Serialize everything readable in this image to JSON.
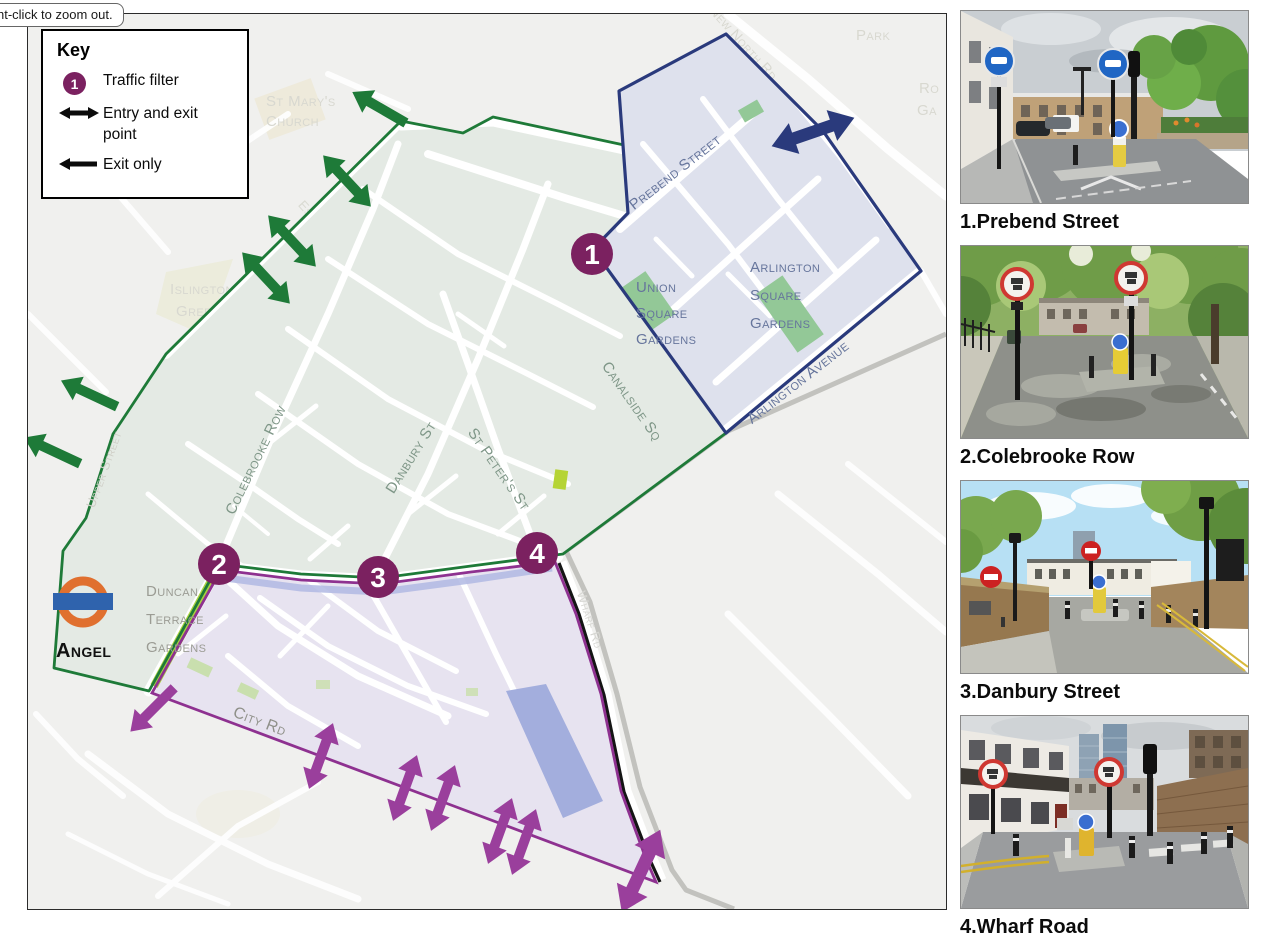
{
  "tooltip": {
    "text": "ht-click to zoom out."
  },
  "key": {
    "title": "Key",
    "items": [
      {
        "symbol": "traffic-filter-circle",
        "number": "1",
        "label": "Traffic filter"
      },
      {
        "symbol": "double-arrow",
        "label": "Entry and exit point"
      },
      {
        "symbol": "single-arrow",
        "label": "Exit only"
      }
    ]
  },
  "map": {
    "filters": [
      {
        "number": "1"
      },
      {
        "number": "2"
      },
      {
        "number": "3"
      },
      {
        "number": "4"
      }
    ],
    "station": {
      "name": "Angel"
    },
    "labels": {
      "prebend": "Prebend Street",
      "union": [
        "Union",
        "Square",
        "Gardens"
      ],
      "arlington_square": [
        "Arlington",
        "Square",
        "Gardens"
      ],
      "arlington_avenue": "Arlington Avenue",
      "canalside": "Canalside Sq",
      "colebrooke": "Colebrooke Row",
      "danbury": "Danbury St",
      "st_peters": "St Peter's St",
      "duncan": [
        "Duncan",
        "Terrace",
        "Gardens"
      ],
      "city_rd": "City Rd",
      "wharf_rd": "Wharf Rd",
      "upper_street": "Upper Street",
      "essex_rd": "Essex Rd",
      "st_marys": [
        "St Mary's",
        "Church"
      ],
      "islington_green": [
        "Islington",
        "Green"
      ],
      "park": "Park",
      "new_north_rd": "New North Rd",
      "rosemary": [
        "Ro",
        "Ga"
      ]
    }
  },
  "photos": [
    {
      "caption": "1.Prebend Street"
    },
    {
      "caption": "2.Colebrooke Row"
    },
    {
      "caption": "3.Danbury Street"
    },
    {
      "caption": "4.Wharf Road"
    }
  ],
  "theme": {
    "mapBg": "#f0f0ee",
    "greenZone": "#e4eae4",
    "blueZone": "#dee1ed",
    "purpleZone": "#e7e3f0",
    "greenLine": "#1e7a38",
    "blueLine": "#2a3a7c",
    "purpleLine": "#8e3190",
    "arrowPurple": "#9a3f9c",
    "filterCircle": "#7b2160",
    "canal": "#c2c2be",
    "basin": "#a3aedd",
    "parkGreen": "#93c897",
    "limeGreen": "#b5d435",
    "duncanStrip": "#a8d23f",
    "roundelRing": "#e0702f",
    "roundelBar": "#2f63ad",
    "greenLabel": "#7e9687",
    "blueLabel": "#66759c",
    "faintLabel": "#d8d8d0",
    "grayLabel": "#8f9089"
  }
}
